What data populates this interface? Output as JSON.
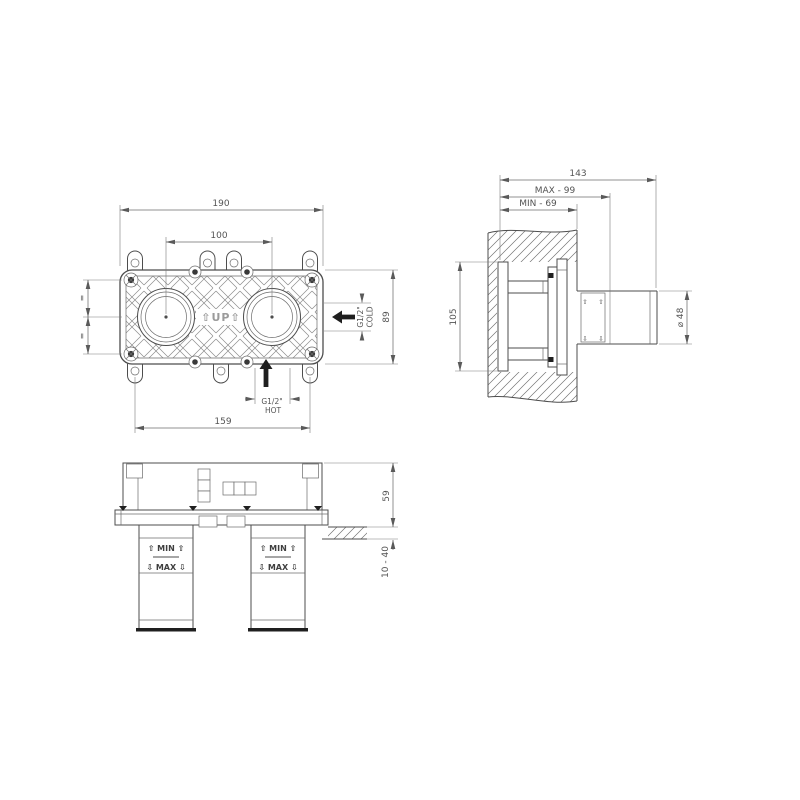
{
  "drawing": {
    "type": "installation technical drawing, concealed two-hole built-in mixer body",
    "colors": {
      "background": "#ffffff",
      "line": "#4d4d4d",
      "dim_text": "#545454",
      "flow_arrow": "#1f1f1f"
    },
    "front": {
      "dim_overall_width": "190",
      "dim_hole_centers": "100",
      "dim_mounting_holes": "159",
      "dim_height": "89",
      "equal_marks": [
        "=",
        "="
      ],
      "up_marking": "⇧UP⇧",
      "cold_port": {
        "thread": "G1/2\"",
        "label": "COLD"
      },
      "hot_port": {
        "thread": "G1/2\"",
        "label": "HOT"
      }
    },
    "side": {
      "dim_depth_total": "143",
      "dim_depth_max": "MAX - 99",
      "dim_depth_min": "MIN - 69",
      "dim_height": "105",
      "dim_diameter": "⌀ 48",
      "valve_arrows": {
        "up": "⇧",
        "down": "⇩"
      }
    },
    "bottom": {
      "dim_body_height": "59",
      "dim_plaster_range": "10 - 40",
      "cartridges": [
        {
          "min_row": "⇧ MIN ⇧",
          "max_row": "⇩ MAX ⇩"
        },
        {
          "min_row": "⇧ MIN ⇧",
          "max_row": "⇩ MAX ⇩"
        }
      ]
    }
  }
}
